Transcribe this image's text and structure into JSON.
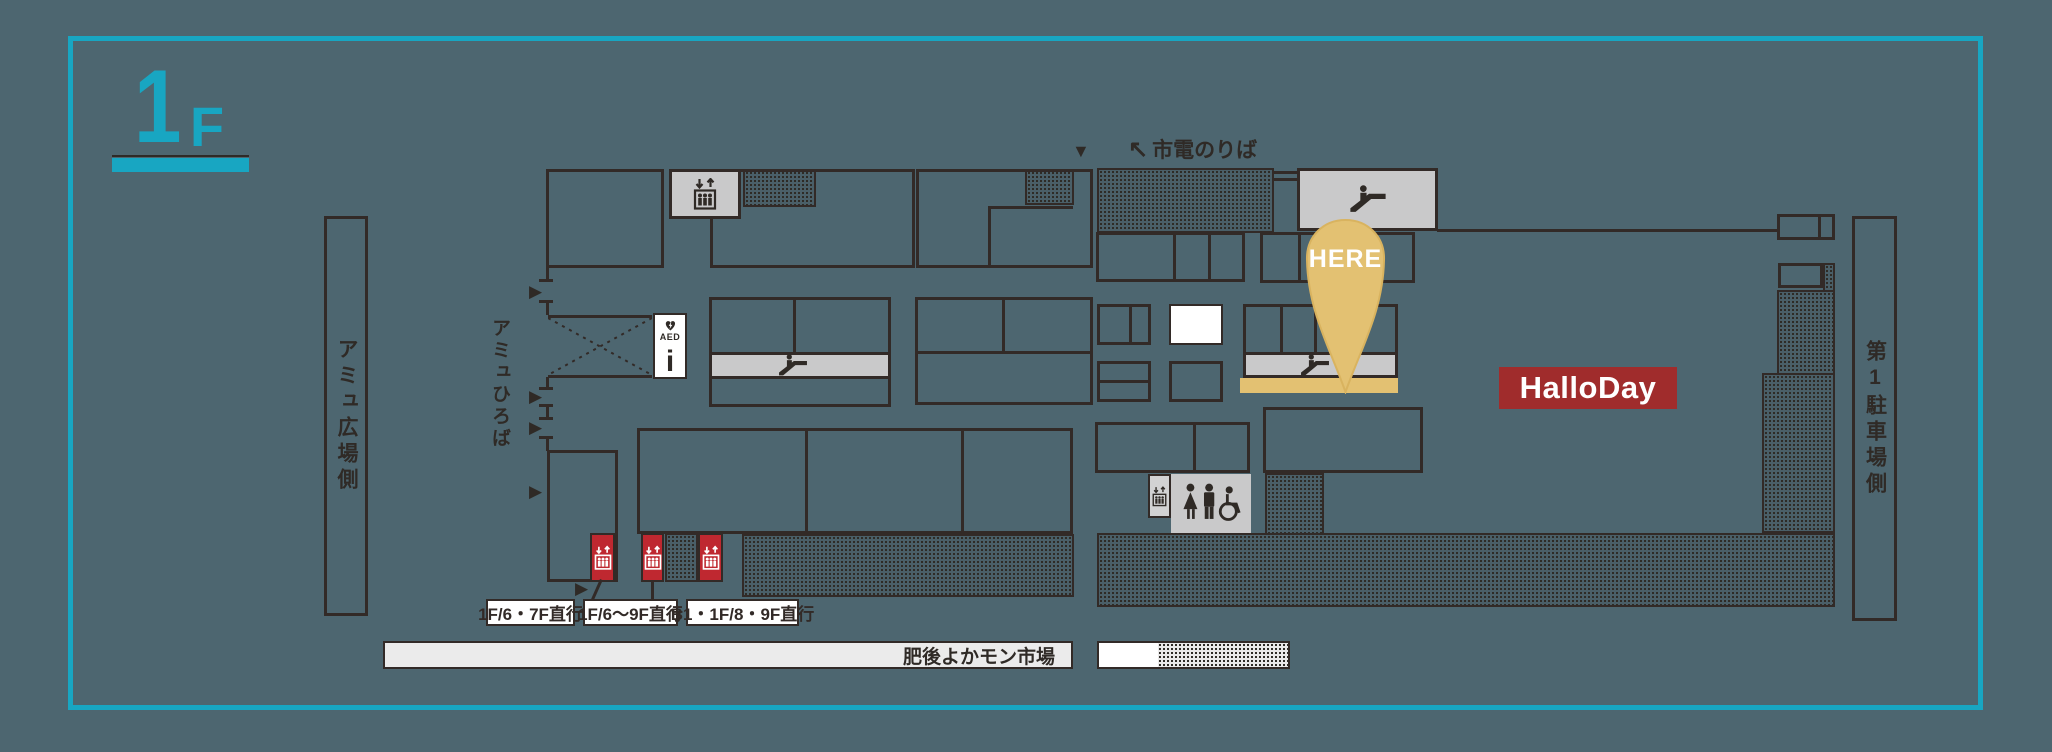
{
  "floor": {
    "big": "1",
    "small": "F"
  },
  "map": {
    "plaza_side_label": "アミュ広場側",
    "plaza_label": "アミュひろば",
    "tram_arrow": "↖",
    "tram_stop_label": "市電のりば",
    "down_arrow": "▼",
    "entrance_arrow": "▶",
    "here_label": "HERE",
    "store_label": "HalloDay",
    "parking_side_label": "第1駐車場側",
    "market_label": "肥後よかモン市場",
    "aed_label": "AED",
    "info_label": "i",
    "elevator_notes": [
      "1F/6・7F直行",
      "1F/6〜9F直行",
      "B1・1F/8・9F直行"
    ]
  },
  "icons": {
    "map_pin_icon": "gold teardrop marker",
    "elevator_icon": "↓↑ box with people",
    "escalator_icon": "person on diagonal steps",
    "restroom_icon": "woman / man / wheelchair figures",
    "aed_icon": "heart with lightning bolt",
    "info_icon": "i",
    "down_arrow": "▼",
    "entrance_arrow": "▶",
    "tram_arrow": "↖"
  },
  "colors": {
    "background": "#4d6670",
    "accent_cyan": "#18a6c2",
    "wall_dark": "#322a27",
    "facility_gray": "#c9c9ca",
    "elevator_red": "#bf2830",
    "store_red": "#a02c2c",
    "highlight_gold": "#e3c172"
  }
}
